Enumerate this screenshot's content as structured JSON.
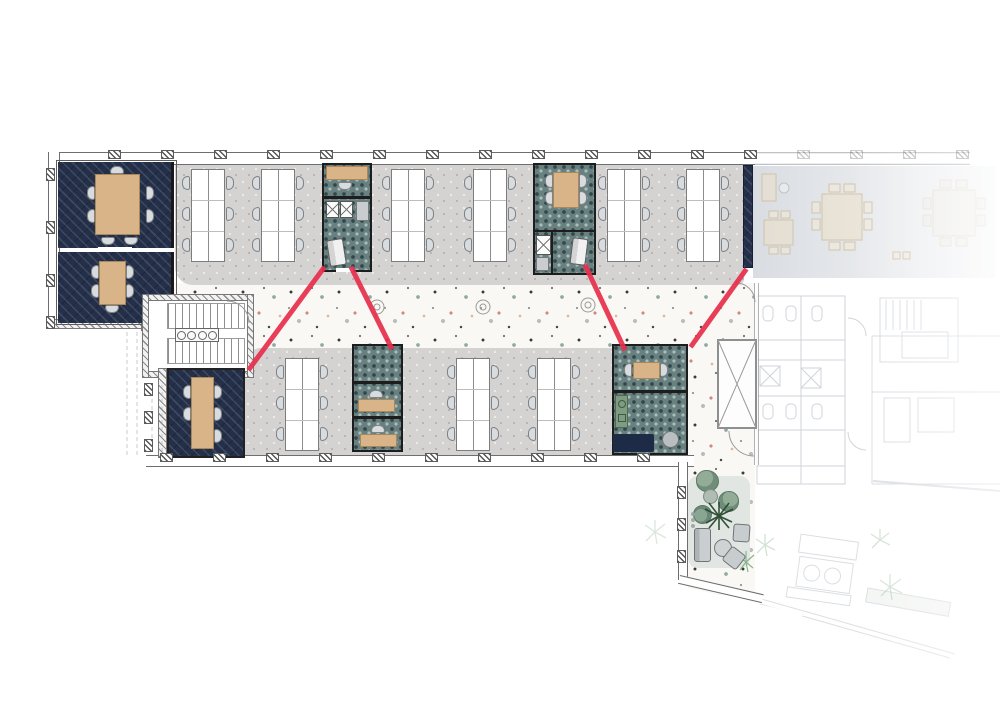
{
  "meta": {
    "title": "Office floor plan — furnished level with highlighted route",
    "drawing_type": "architectural-floor-plan"
  },
  "palette": {
    "accent_red": "#e8304d",
    "navy_carpet": "#24304a",
    "teal_carpet": "#68807f",
    "wood": "#d8b488",
    "open_floor_gray": "#d4d3d1",
    "terrazzo_base": "#faf8f4",
    "faded_context_line": "#8a93a3"
  },
  "zones": {
    "meeting_room_large": {
      "label": "Meeting room (8-seat wood table)",
      "seats": 7
    },
    "meeting_room_small": {
      "label": "Meeting room (5-seat wood table)",
      "seats": 5
    },
    "open_office_north": {
      "label": "Open office north — 6 desk banks x 6 seats",
      "desk_banks": 6
    },
    "open_office_south": {
      "label": "Open office south — 3 desk banks x 6 seats",
      "desk_banks": 3
    },
    "focus_block_a": {
      "label": "Focus block A — desk, lockers, phone booth"
    },
    "meeting_block_b": {
      "label": "Meeting block B — 4-seat table, locker, phone booth"
    },
    "focus_block_c": {
      "label": "Focus block C — two solo desks"
    },
    "lounge_room_d": {
      "label": "Lounge room D — 2-seat table, pantry counter, sofa, pouf"
    },
    "meeting_room_south": {
      "label": "Meeting room south (5-seat table)"
    },
    "stairwell": {
      "label": "Stairwell core"
    },
    "shaft": {
      "label": "Shaft / skylight (X)"
    },
    "corridor": {
      "label": "Terrazzo corridor"
    },
    "terrace_lounge": {
      "label": "Indoor terrace lounge — poufs, plant, sofa"
    },
    "faded_context": {
      "label": "Adjacent areas shown faded: canteen tables, WC block, stair, terrace"
    }
  },
  "red_route": {
    "color": "#e8304d",
    "stroke_width": 5,
    "segments": [
      {
        "x1": 250,
        "y1": 368,
        "x2": 323,
        "y2": 269
      },
      {
        "x1": 352,
        "y1": 269,
        "x2": 391,
        "y2": 347
      },
      {
        "x1": 586,
        "y1": 267,
        "x2": 624,
        "y2": 348
      },
      {
        "x1": 745,
        "y1": 271,
        "x2": 692,
        "y2": 345
      }
    ]
  }
}
